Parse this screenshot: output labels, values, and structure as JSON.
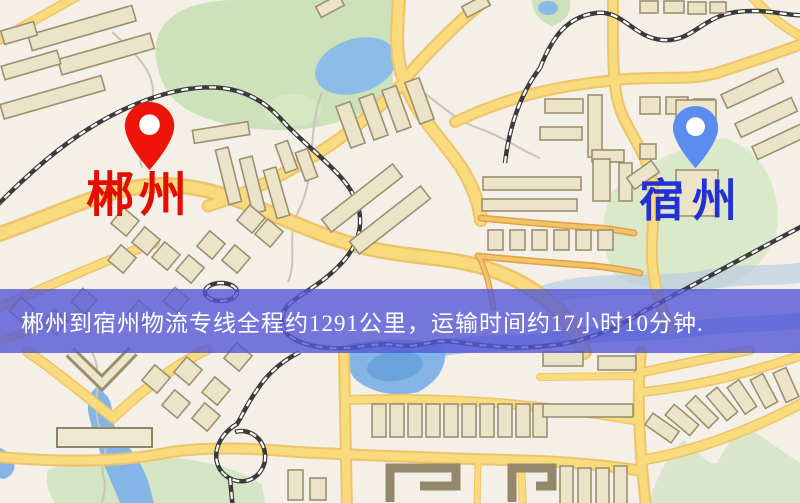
{
  "markers": {
    "origin": {
      "name": "郴州",
      "pin_icon": "map-pin",
      "pin_color": "#ee1409",
      "label_color": "#e30d04"
    },
    "destination": {
      "name": "宿州",
      "pin_icon": "map-pin",
      "pin_color": "#5b8cf0",
      "label_color": "#2231d0"
    }
  },
  "banner": {
    "text": "郴州到宿州物流专线全程约1291公里，运输时间约17小时10分钟.",
    "background_color": "#5457d6",
    "text_color": "#ffffff"
  },
  "map_style": {
    "background": "#f4efe7",
    "road_fill": "#f9db7d",
    "road_casing": "#edc469",
    "minor_road": "#f2c468",
    "park": "#cfe3bd",
    "water": "#8abbe8",
    "building_fill": "#ece4c9",
    "building_stroke": "#9c9072",
    "railway": "#3b3b3b"
  }
}
